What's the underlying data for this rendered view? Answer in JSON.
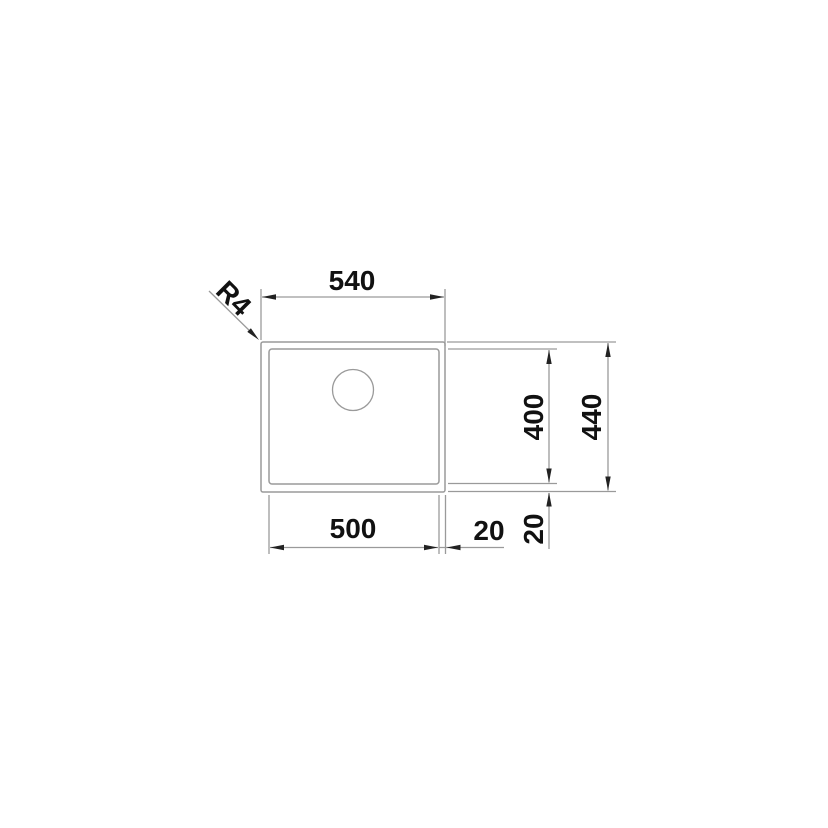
{
  "drawing": {
    "dimensions": {
      "width_overall": "540",
      "corner_radius": "R4",
      "height_bowl": "400",
      "height_overall": "440",
      "width_bowl": "500",
      "rim_right": "20",
      "rim_bottom": "20"
    },
    "colors": {
      "background": "#ffffff",
      "line": "#9a9a9a",
      "arrow": "#222222",
      "text": "#111111"
    }
  }
}
